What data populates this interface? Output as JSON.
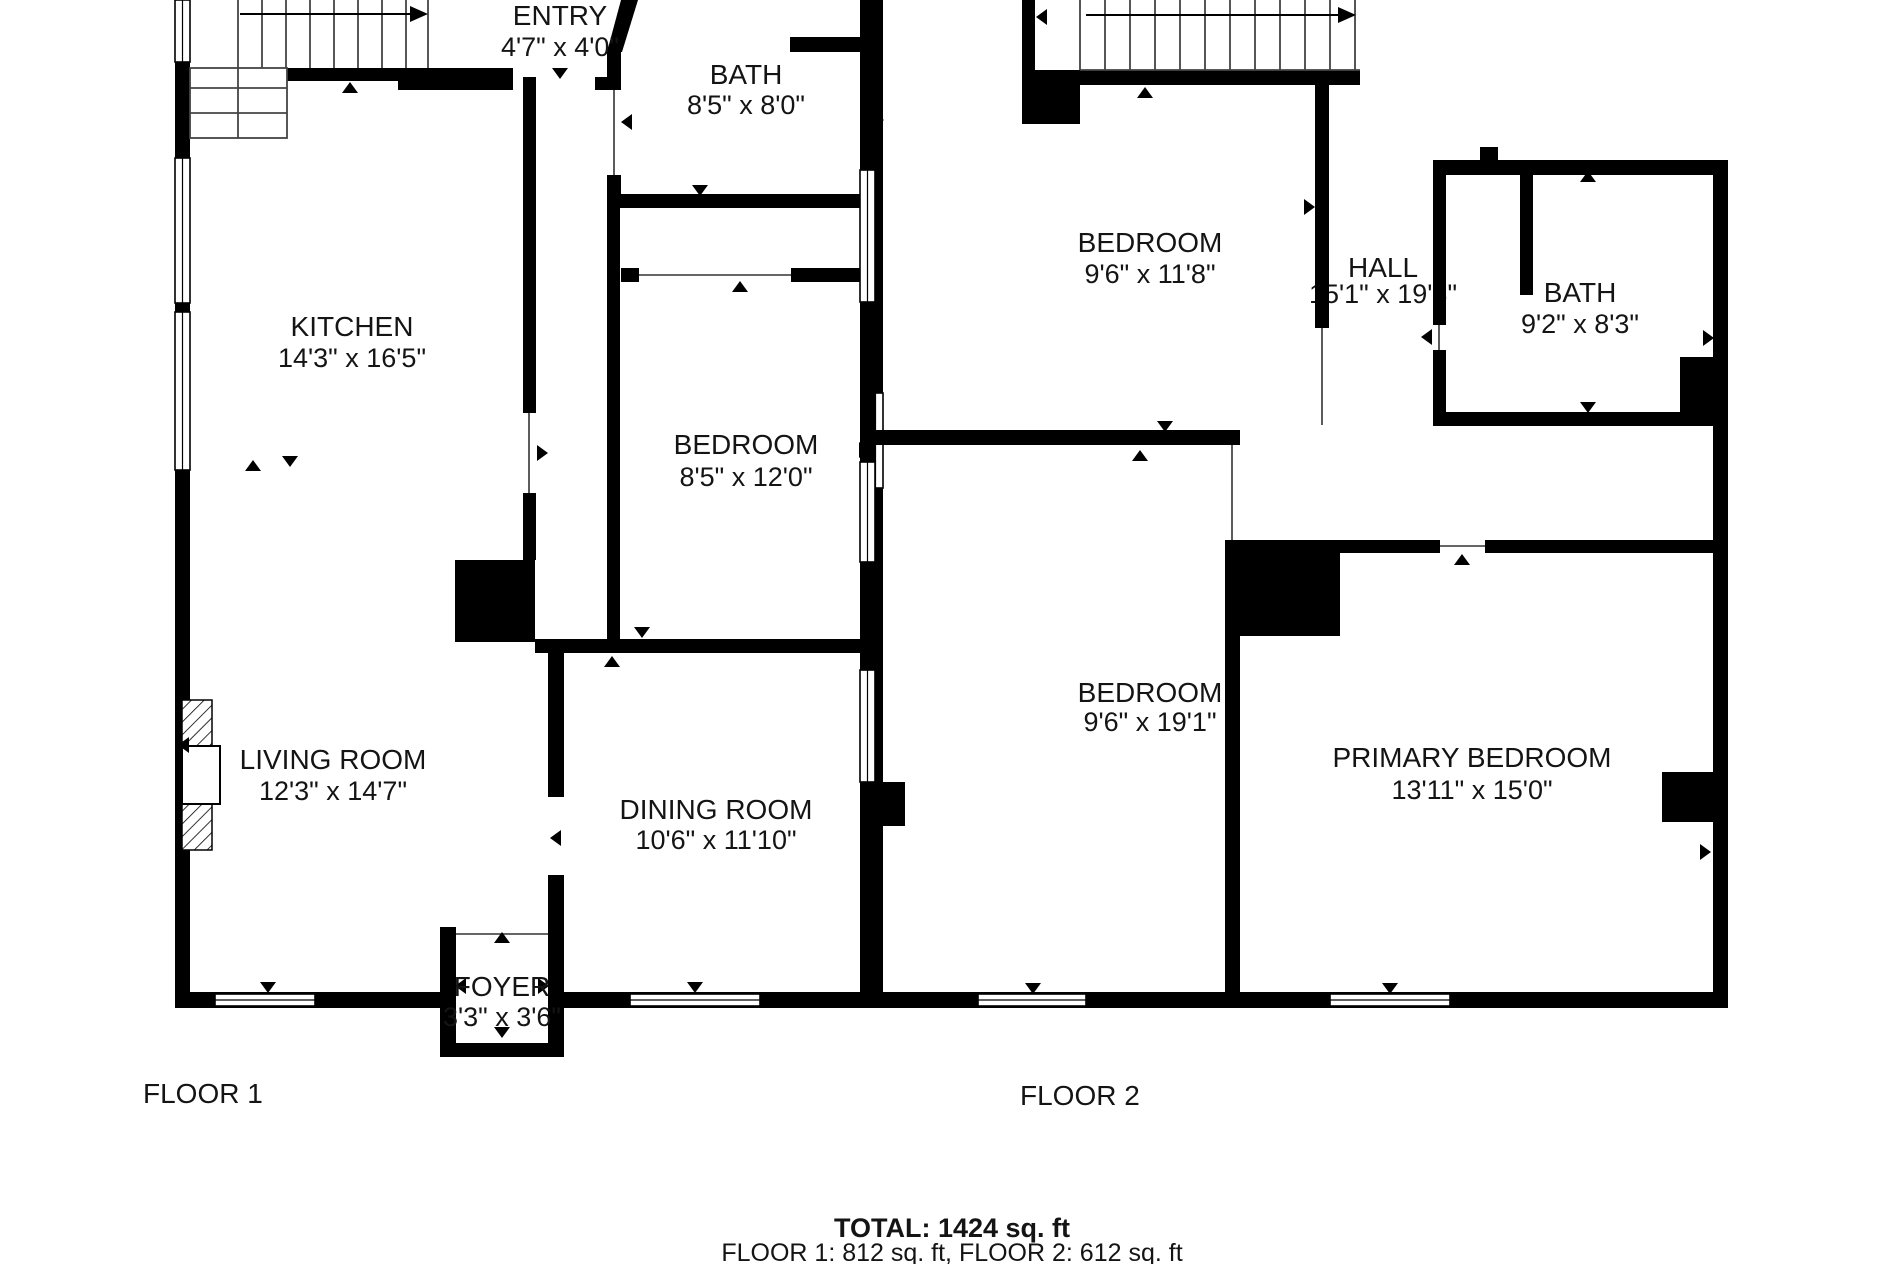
{
  "title": "Two-floor house floor plan",
  "colors": {
    "wall": "#000000",
    "text": "#141414",
    "background": "#ffffff"
  },
  "icons": {
    "stair_direction": "arrow-right",
    "opening_marker": "triangle-arrow",
    "fireplace": "hatched-rectangle"
  },
  "floor1": {
    "label": "FLOOR 1",
    "rooms": [
      {
        "name": "ENTRY",
        "dims": "4'7\" x 4'0\""
      },
      {
        "name": "BATH",
        "dims": "8'5\" x 8'0\""
      },
      {
        "name": "KITCHEN",
        "dims": "14'3\" x 16'5\""
      },
      {
        "name": "BEDROOM",
        "dims": "8'5\" x 12'0\""
      },
      {
        "name": "LIVING ROOM",
        "dims": "12'3\" x 14'7\""
      },
      {
        "name": "DINING ROOM",
        "dims": "10'6\" x 11'10\""
      },
      {
        "name": "FOYER",
        "dims": "3'3\" x 3'6\""
      }
    ]
  },
  "floor2": {
    "label": "FLOOR 2",
    "rooms": [
      {
        "name": "BEDROOM",
        "dims": "9'6\" x 11'8\""
      },
      {
        "name": "HALL",
        "dims": "15'1\" x 19'8\""
      },
      {
        "name": "BATH",
        "dims": "9'2\" x 8'3\""
      },
      {
        "name": "BEDROOM",
        "dims": "9'6\" x 19'1\""
      },
      {
        "name": "PRIMARY BEDROOM",
        "dims": "13'11\" x 15'0\""
      }
    ]
  },
  "summary": {
    "total": "TOTAL: 1424 sq. ft",
    "floors": "FLOOR 1: 812 sq. ft, FLOOR 2: 612 sq. ft"
  }
}
